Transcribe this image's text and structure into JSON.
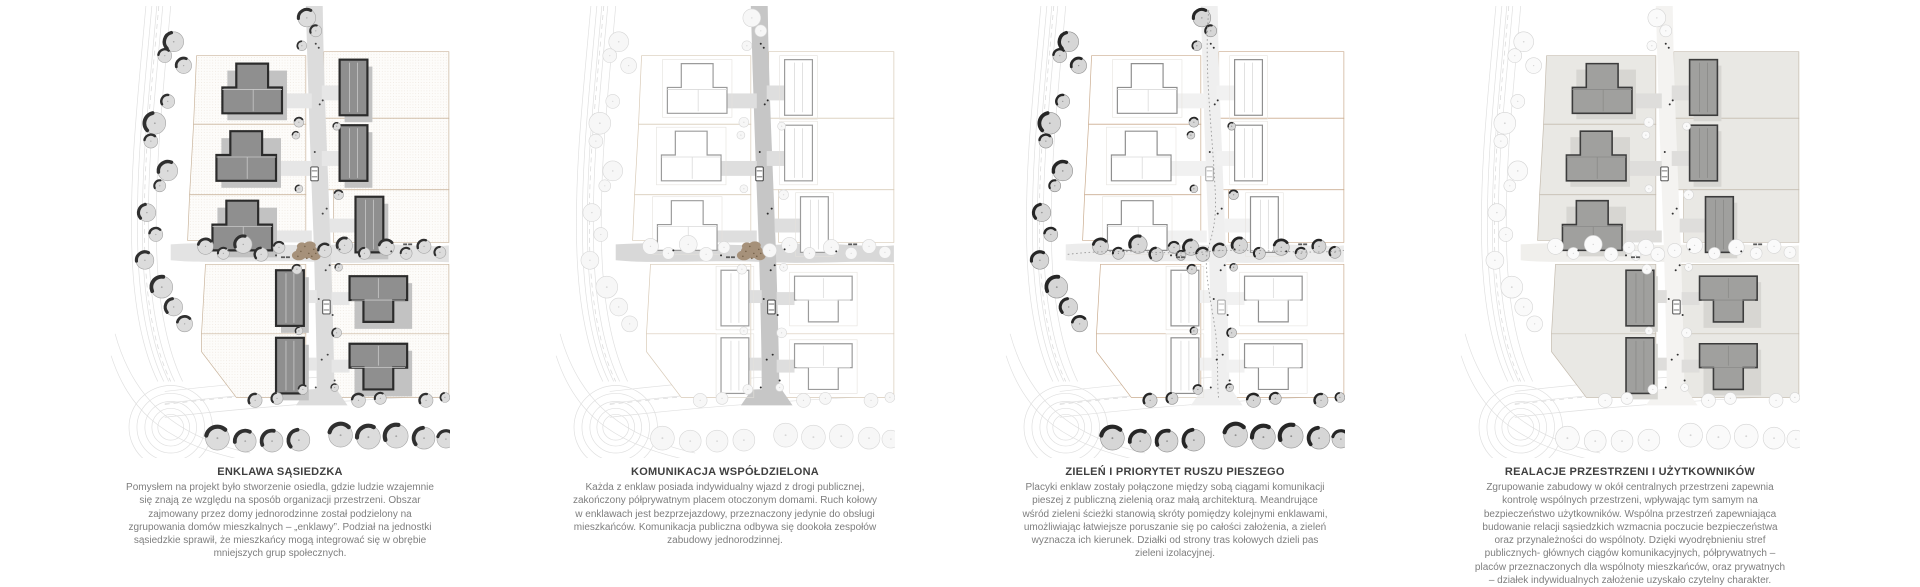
{
  "board": {
    "background": "#ffffff",
    "kind": "architectural masterplan concept board",
    "panel_count": 4
  },
  "panels": [
    {
      "id": "enklawa-sasiedzka",
      "title": "ENKLAWA SĄSIEDZKA",
      "body": "Pomysłem na projekt było stworzenie osiedla, gdzie ludzie wzajemnie się znają ze względu na sposób organizacji przestrzeni. Obszar zajmowany przez domy jednorodzinne został podzielony na zgrupowania domów mieszkalnych – „enklawy”. Podział na jednostki sąsiedzkie sprawił, że mieszkańcy mogą integrować się w obrębie mniejszych grup społecznych.",
      "style": {
        "houseFill": "#8f8f8f",
        "houseStroke": "#2b2b2b",
        "houseDetail": "#c9c9c9",
        "parcelFill": "dots",
        "parcelStroke": "#c9b49c",
        "roadFill": "#dcdcdc",
        "pathFill": "#e3e3e3",
        "driveFill": "#e6e6e6",
        "padFill": "#c2c2c2",
        "padStroke": "#dcdcdc",
        "padOffset": 5,
        "treeFill": "#dcdcdc",
        "treeStroke": "#a4a4a4",
        "treeCrescent": "#2f2f2f",
        "plaza": "wood-blob",
        "blobFill": "#a6917a",
        "blobDot": "#77644c",
        "peopleColor": "#454545",
        "carColor": "#3f3f3f",
        "meander": false
      }
    },
    {
      "id": "komunikacja-wspoldzielona",
      "title": "KOMUNIKACJA WSPÓŁDZIELONA",
      "body": "Każda z enklaw posiada indywidualny wjazd z drogi publicznej, zakończony półprywatnym placem otoczonym domami. Ruch kołowy w enklawach jest bezprzejazdowy, przeznaczony jedynie do obsługi mieszkańców. Komunikacja publiczna odbywa się dookoła zespołów zabudowy jednorodzinnej.",
      "style": {
        "houseFill": "#ffffff",
        "houseStroke": "#9b9b9b",
        "houseDetail": "#dadada",
        "parcelFill": "#ffffff",
        "parcelStroke": "#d8cab7",
        "roadFill": "#c6c6c6",
        "pathFill": "#d8d8d8",
        "driveFill": "#dedede",
        "padFill": "none",
        "padStroke": "#e4e1dc",
        "padOffset": 0,
        "treeFill": "#f7f7f7",
        "treeStroke": "#d7d7d7",
        "treeCrescent": null,
        "plaza": "wood-blob",
        "blobFill": "#a6917a",
        "blobDot": "#77644c",
        "peopleColor": "#2b2b2b",
        "carColor": "#2f2f2f",
        "meander": false
      }
    },
    {
      "id": "zielen-priorytet-ruchu-pieszego",
      "title": "ZIELEŃ I PRIORYTET RUSZU PIESZEGO",
      "body": "Placyki enklaw zostały połączone między sobą ciągami komunikacji pieszej z publiczną zielenią oraz małą architekturą. Meandrujące wśród zieleni ścieżki stanowią skróty pomiędzy kolejnymi enklawami, umożliwiając łatwiejsze poruszanie się po całości założenia, a zieleń wyznacza ich kierunek. Działki od strony tras kołowych dzieli pas zieleni izolacyjnej.",
      "style": {
        "houseFill": "#ffffff",
        "houseStroke": "#8f8f8f",
        "houseDetail": "#dadada",
        "parcelFill": "#ffffff",
        "parcelStroke": "#c9ab8e",
        "roadFill": "#efefef",
        "pathFill": "#ececec",
        "driveFill": "#f1f1f1",
        "padFill": "none",
        "padStroke": "#e6e3de",
        "padOffset": 0,
        "treeFill": "#d6d6d6",
        "treeStroke": "#8f8f8f",
        "treeCrescent": "#262626",
        "plaza": "trees",
        "blobFill": null,
        "blobDot": null,
        "peopleColor": "#333333",
        "carColor": "#9a9a9a",
        "meander": true
      }
    },
    {
      "id": "relacje-przestrzeni-i-uzytkownikow",
      "title": "REALACJE PRZESTRZENI I UŻYTKOWNIKÓW",
      "body": "Zgrupowanie zabudowy w okół centralnych przestrzeni zapewnia kontrolę wspólnych przestrzeni, wpływając tym samym na bezpieczeństwo użytkowników. Wspólna przestrzeń zapewniająca budowanie relacji sąsiedzkich wzmacnia poczucie bezpieczeństwa oraz przynależności do wspólnoty. Dzięki wyodrębnieniu stref publicznych- głównych ciągów komunikacyjnych, półprywatnych – placów przeznaczonych dla wspólnoty mieszkańców, oraz prywatnych – działek indywidualnych założenie uzyskało czytelny charakter.",
      "style": {
        "houseFill": "#a0a09e",
        "houseStroke": "#3c3c3c",
        "houseDetail": "#8a8a88",
        "parcelFill": "#e9e8e4",
        "parcelStroke": "#c4bbae",
        "roadFill": "#f4f3f1",
        "pathFill": "#f0efec",
        "driveFill": "#dedddb",
        "padFill": "#d7d6d2",
        "padStroke": "#dcdbd7",
        "padOffset": 4,
        "treeFill": "#fafafa",
        "treeStroke": "#d4d4d4",
        "treeCrescent": null,
        "plaza": "trees",
        "blobFill": null,
        "blobDot": null,
        "peopleColor": "#333333",
        "carColor": "#3f3f3f",
        "meander": false
      }
    }
  ]
}
